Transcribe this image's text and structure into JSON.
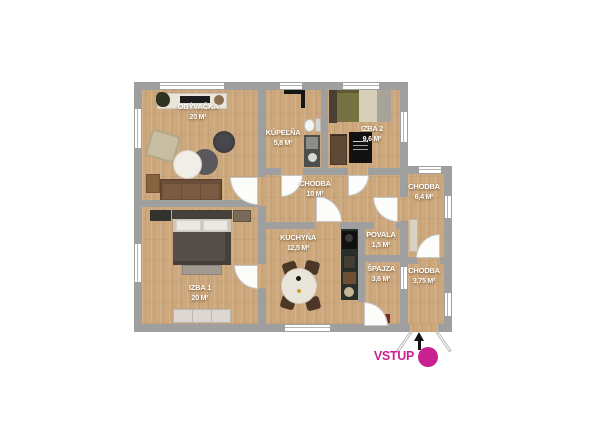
{
  "plan": {
    "rooms": [
      {
        "id": "obyvacka",
        "name": "OBÝVAČKA",
        "area": "20 M²"
      },
      {
        "id": "kupelna",
        "name": "KÚPEĽŇA",
        "area": "5,8 M²"
      },
      {
        "id": "izba2",
        "name": "IZBA 2",
        "area": "9,6 M²"
      },
      {
        "id": "chodba10",
        "name": "CHODBA",
        "area": "10 M²"
      },
      {
        "id": "chodba64",
        "name": "CHODBA",
        "area": "6,4 M²"
      },
      {
        "id": "kuchyna",
        "name": "KUCHYŇA",
        "area": "12,5 M²"
      },
      {
        "id": "povala",
        "name": "POVALA",
        "area": "1,5 M²"
      },
      {
        "id": "spajza",
        "name": "ŠPAJZA",
        "area": "3,6 M²"
      },
      {
        "id": "chodba375",
        "name": "CHODBA",
        "area": "3,75 M²"
      },
      {
        "id": "izba1",
        "name": "IZBA 1",
        "area": "20 M²"
      }
    ],
    "entrance": {
      "label": "VSTUP"
    },
    "colors": {
      "accent_magenta": "#ca2191",
      "wall_gray": "#9f9f9f",
      "floor_wood": "#cda87c"
    }
  }
}
